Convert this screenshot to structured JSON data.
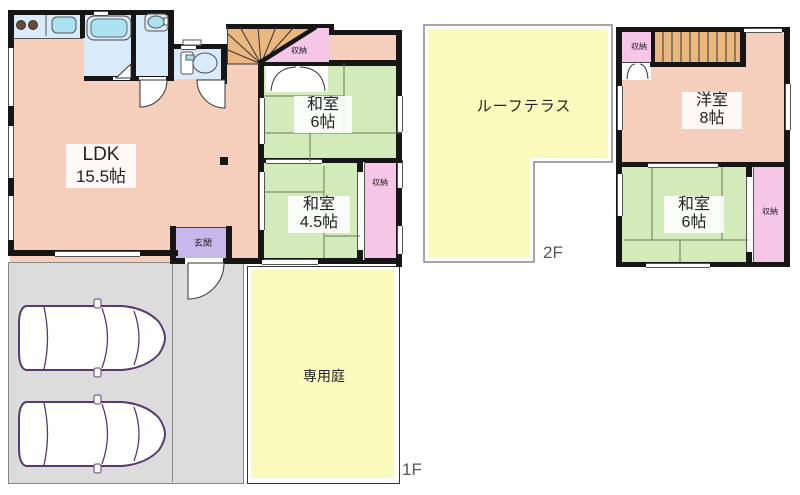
{
  "floor1": {
    "label": "1F",
    "ldk": {
      "name": "LDK",
      "size": "15.5帖"
    },
    "washitsu6": {
      "name": "和室",
      "size": "6帖"
    },
    "washitsu45": {
      "name": "和室",
      "size": "4.5帖"
    },
    "closet_under_stairs": "収納",
    "closet_45": "収納",
    "genkan": "玄関",
    "garden": "専用庭"
  },
  "floor2": {
    "label": "2F",
    "terrace": "ルーフテラス",
    "yoshitsu8": {
      "name": "洋室",
      "size": "8帖"
    },
    "washitsu6": {
      "name": "和室",
      "size": "6帖"
    },
    "closet_top": "収納",
    "closet_side": "収納"
  },
  "colors": {
    "wall": "#161616",
    "salmon": "#f6cebc",
    "green": "#d3ebba",
    "yellow": "#fbfabd",
    "pink": "#f6c6e8",
    "lavender": "#c6b8ea",
    "blue": "#d9ebf8",
    "cyan": "#abe2f2",
    "tan": "#eab87e",
    "parking": "#dcdcdc",
    "car_outline": "#5a3a70",
    "line": "#444"
  }
}
